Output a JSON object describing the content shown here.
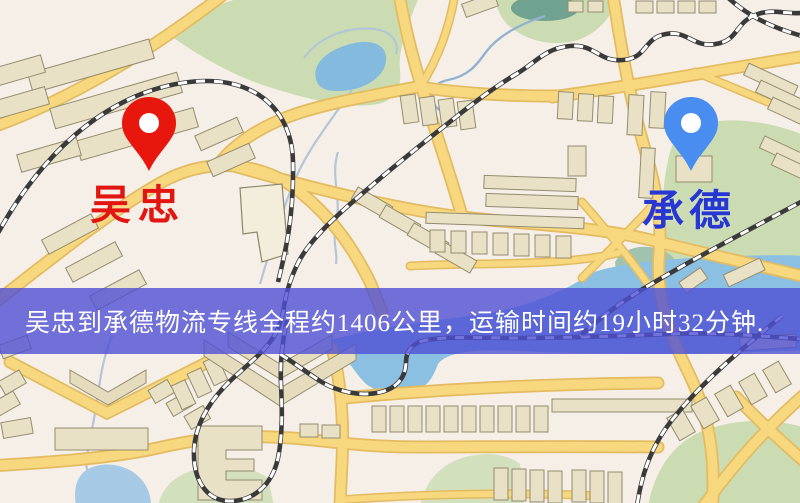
{
  "map": {
    "origin_marker": {
      "label": "吴忠",
      "pin_color": "#e8170d",
      "label_color": "#e21511"
    },
    "destination_marker": {
      "label": "承德",
      "pin_color": "#4a8df0",
      "label_color": "#2637d2"
    },
    "banner": {
      "text": "吴忠到承德物流专线全程约1406公里，运输时间约19小时32分钟.",
      "background_color": "#4f50d5",
      "text_color": "#ffffff"
    },
    "route_summary": {
      "origin": "吴忠",
      "destination": "承德",
      "service_type": "物流专线",
      "distance_text": "全程约1406公里",
      "duration_text": "运输时间约19小时32分钟"
    },
    "legend_colors": {
      "road": "#f7d87f",
      "railway": "#3a3a3a",
      "water": "#85badf",
      "park": "#cbdcb2",
      "building": "#e9e1c6",
      "background": "#f5efe7"
    }
  }
}
